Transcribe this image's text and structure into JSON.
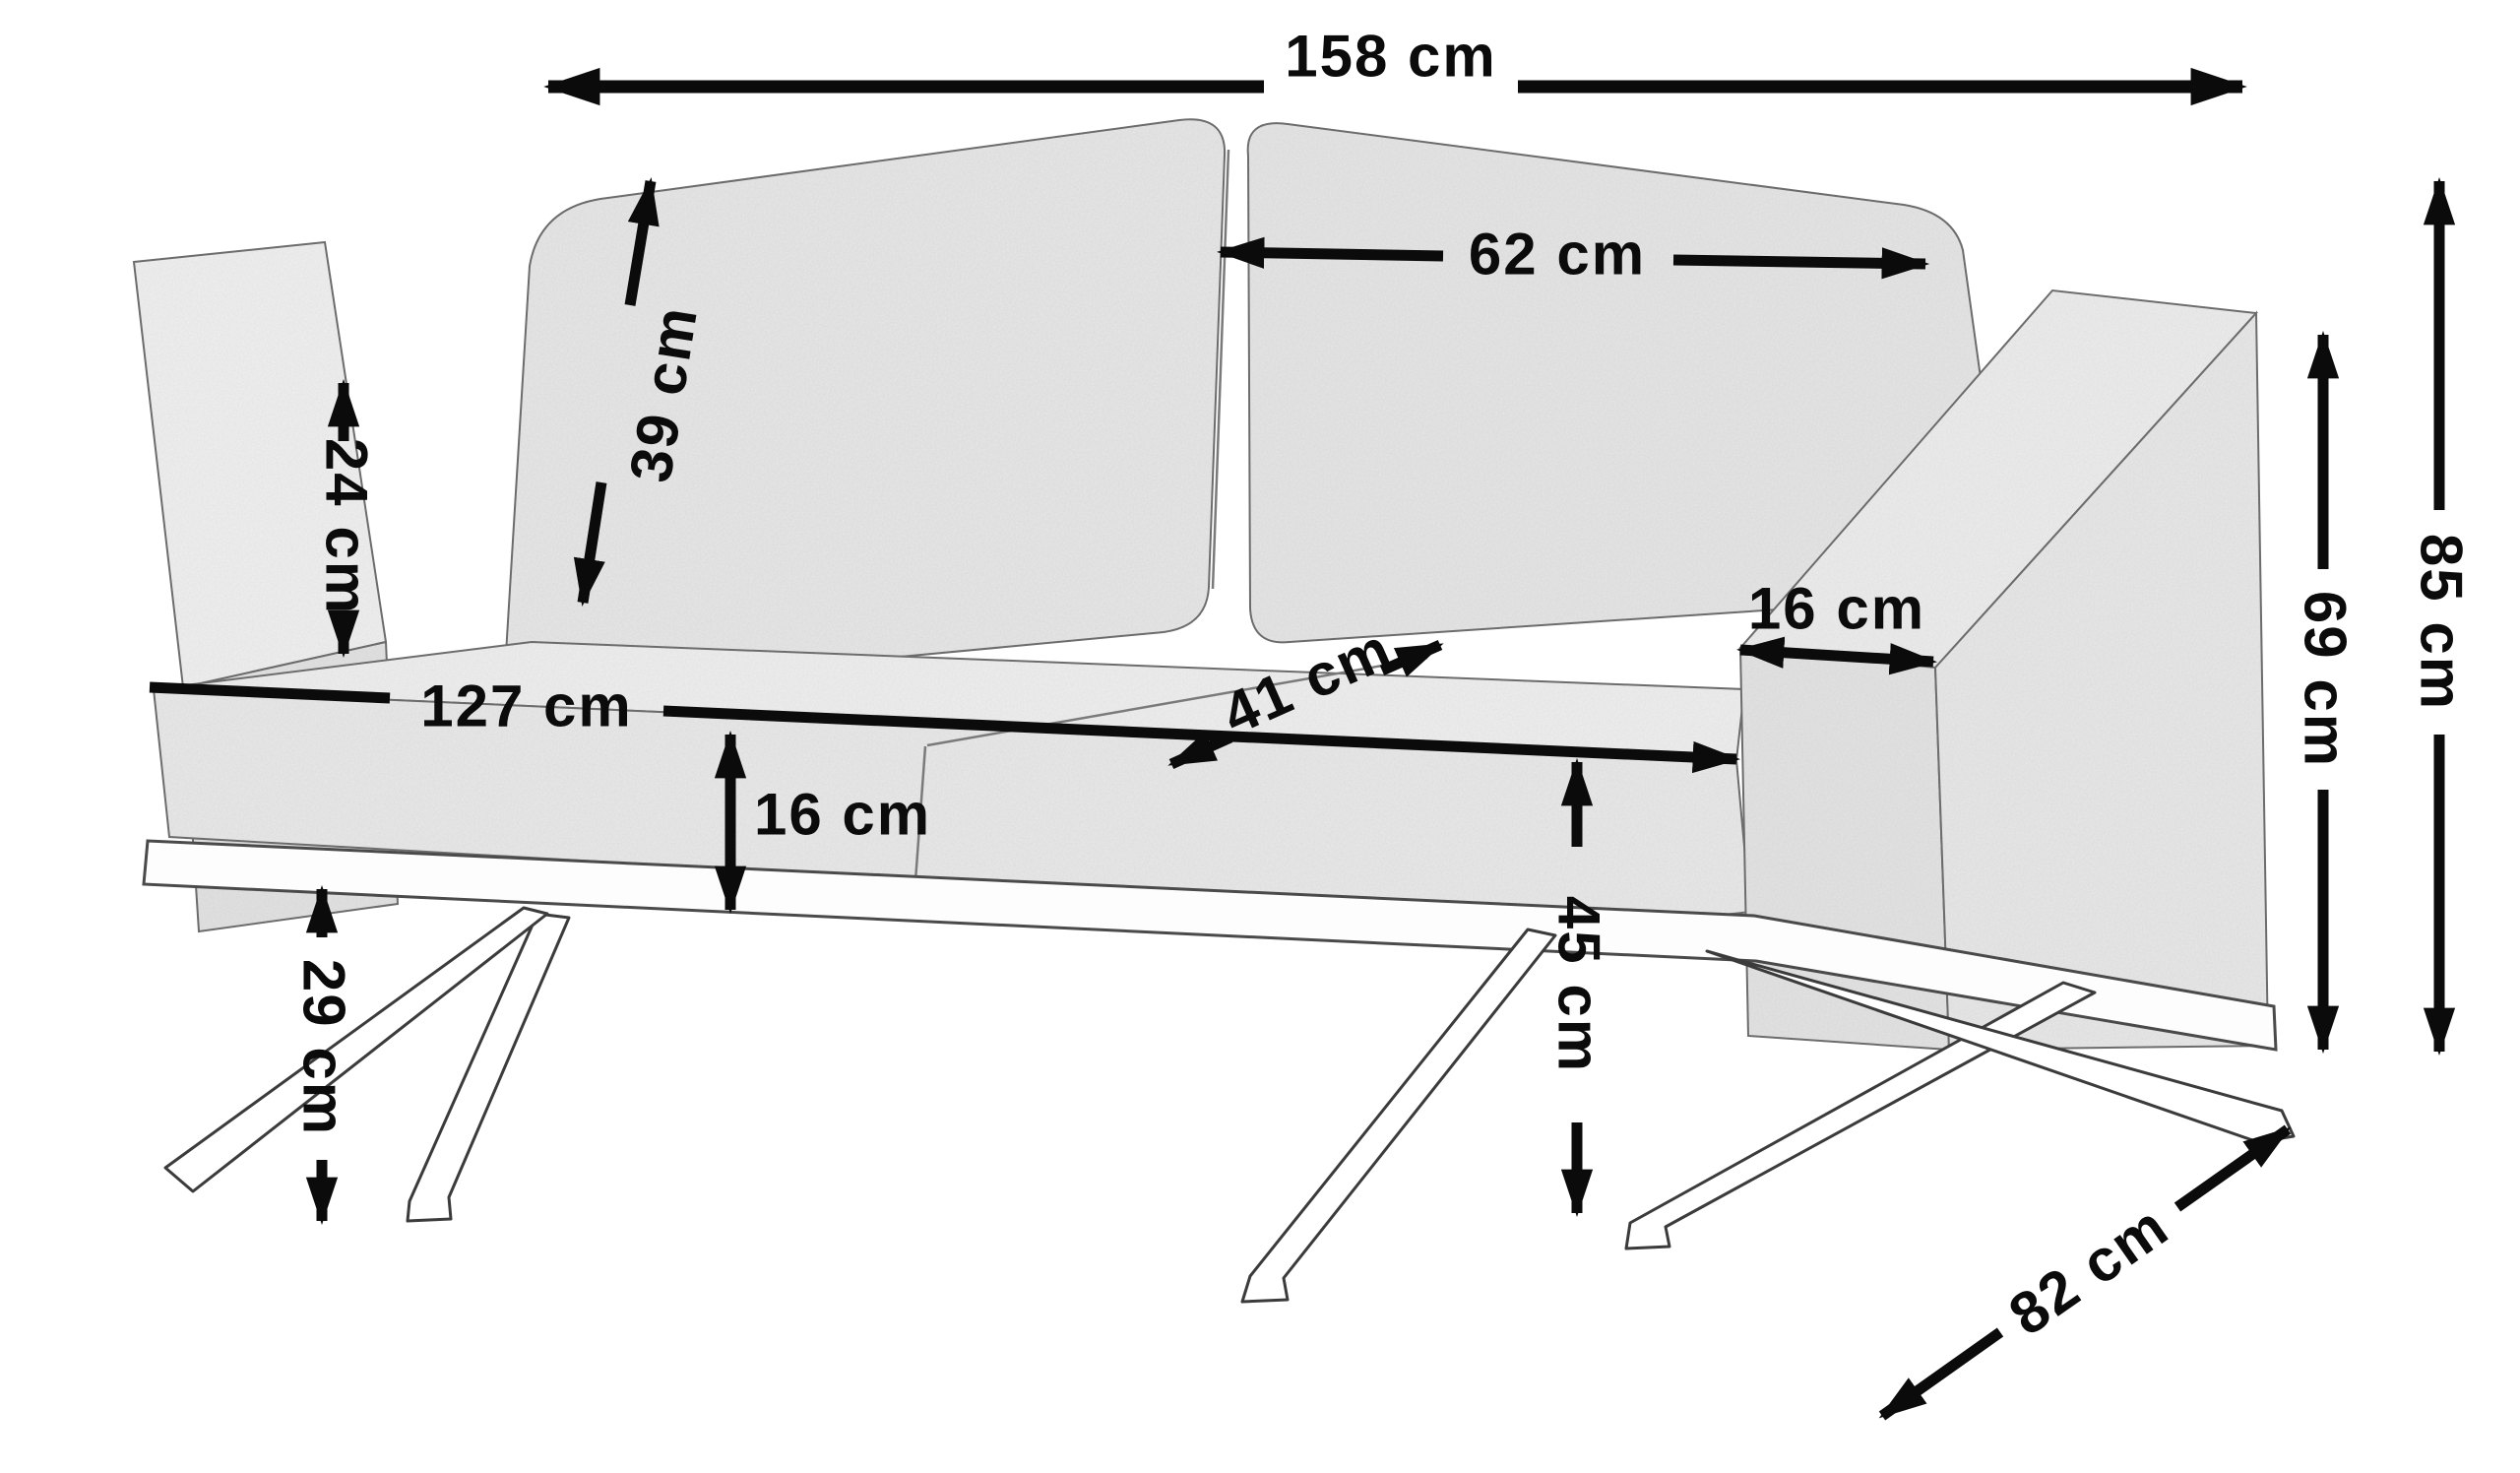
{
  "unit": "cm",
  "dimensions": {
    "overall_width": {
      "label": "158 cm",
      "value": 158
    },
    "back_cushion_width": {
      "label": "62 cm",
      "value": 62
    },
    "back_cushion_height": {
      "label": "39 cm",
      "value": 39
    },
    "armrest_top_depth": {
      "label": "24 cm",
      "value": 24
    },
    "seat_width": {
      "label": "127 cm",
      "value": 127
    },
    "seat_depth": {
      "label": "41 cm",
      "value": 41
    },
    "seat_cushion_thickness": {
      "label": "16 cm",
      "value": 16
    },
    "armrest_width": {
      "label": "16 cm",
      "value": 16
    },
    "under_clearance_height": {
      "label": "29 cm",
      "value": 29
    },
    "seat_height": {
      "label": "45 cm",
      "value": 45
    },
    "overall_height": {
      "label": "85 cm",
      "value": 85
    },
    "armrest_height": {
      "label": "69 cm",
      "value": 69
    },
    "overall_depth": {
      "label": "82 cm",
      "value": 82
    }
  },
  "style": {
    "annotation_color": "#0b0b0b",
    "fabric_color": "#e9e9e9",
    "background": "#ffffff"
  }
}
